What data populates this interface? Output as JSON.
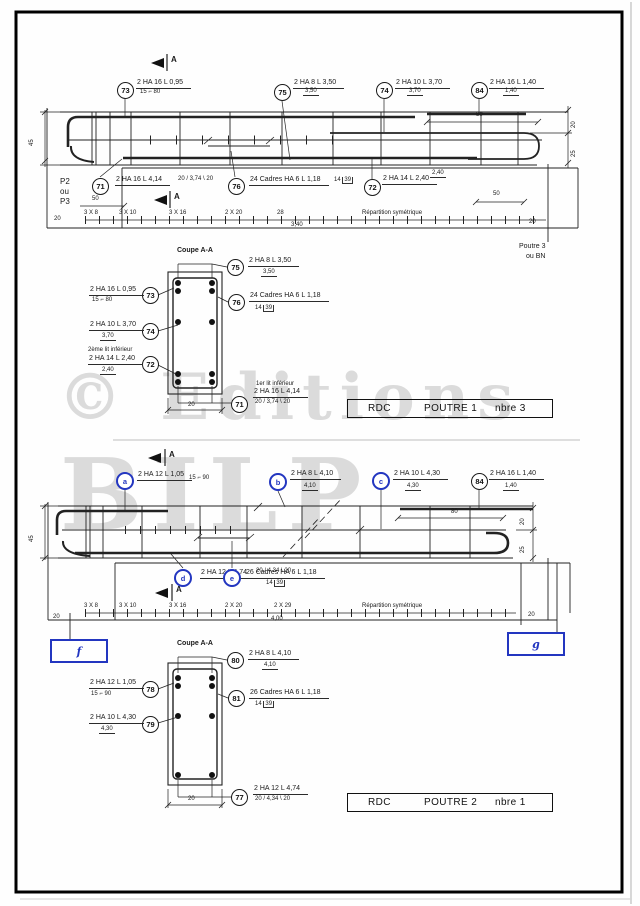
{
  "shared": {
    "section_arrow": "A",
    "repartition": "Répartition symétrique",
    "coupe_title": "Coupe A-A"
  },
  "watermark": {
    "line1": "© Editions",
    "line2": "BILP"
  },
  "beam1": {
    "c73": {
      "id": "73",
      "label": "2 HA 16 L 0,95",
      "sub": "15 ⌐ 80"
    },
    "c75": {
      "id": "75",
      "label": "2 HA 8 L 3,50",
      "sub": "3,50"
    },
    "c74": {
      "id": "74",
      "label": "2 HA 10 L 3,70",
      "sub": "3,70"
    },
    "c84": {
      "id": "84",
      "label": "2 HA 16 L 1,40",
      "sub": "1,40"
    },
    "c71": {
      "id": "71",
      "label": "2 HA 16 L 4,14",
      "sub": "20 / 3,74 \\ 20"
    },
    "c76": {
      "id": "76",
      "label": "24 Cadres HA 6 L 1,18",
      "sub_a": "14",
      "sub_b": "39"
    },
    "c72": {
      "id": "72",
      "label": "2 HA 14 L 2,40",
      "sub": "2,40"
    },
    "support_left": [
      "P2",
      "ou",
      "P3"
    ],
    "support_right": [
      "Poutre 3",
      "ou BN"
    ],
    "dims": {
      "height": "45",
      "cover_top": "20",
      "cover_side": "25",
      "len84": "80",
      "fifty_left": "50",
      "fifty_right": "50",
      "twenty_left": "20",
      "twenty_right": "20",
      "total": "3,40"
    },
    "spacings": [
      "3 X 8",
      "3 X 10",
      "3 X 16",
      "2 X 20",
      "28"
    ],
    "notes": {
      "lit2": "2ème lit inférieur",
      "lit1": "1er lit inférieur"
    },
    "coupe_width": "20"
  },
  "titlebox1": {
    "level": "RDC",
    "name": "POUTRE 1",
    "count": "nbre 3"
  },
  "beam2": {
    "ca": {
      "id": "a",
      "label": "2 HA 12 L 1,05",
      "sub": "15 ⌐ 90"
    },
    "cb": {
      "id": "b",
      "label": "2 HA 8 L 4,10",
      "sub": "4,10"
    },
    "cc": {
      "id": "c",
      "label": "2 HA 10 L 4,30",
      "sub": "4,30"
    },
    "c84": {
      "id": "84",
      "label": "2 HA 16 L 1,40",
      "sub": "1,40"
    },
    "cd": {
      "id": "d",
      "label": "2 HA 12 L 4,74",
      "sub": "20 / 4,34 \\ 20"
    },
    "ce": {
      "id": "e",
      "label": "26 Cadres HA 6 L 1,18",
      "sub_a": "14",
      "sub_b": "39"
    },
    "dims": {
      "height": "45",
      "cover_top": "20",
      "cover_side": "25",
      "len84": "80",
      "twenty_left": "20",
      "twenty_right": "20",
      "total": "4,00"
    },
    "spacings": [
      "3 X 8",
      "3 X 10",
      "3 X 16",
      "2 X 20",
      "2 X 29"
    ],
    "markers": {
      "f": "f",
      "g": "g"
    },
    "coupe_ids": {
      "i80": "80",
      "i78": "78",
      "i81": "81",
      "i79": "79",
      "i77": "77"
    },
    "coupe_width": "20"
  },
  "titlebox2": {
    "level": "RDC",
    "name": "POUTRE 2",
    "count": "nbre 1"
  }
}
